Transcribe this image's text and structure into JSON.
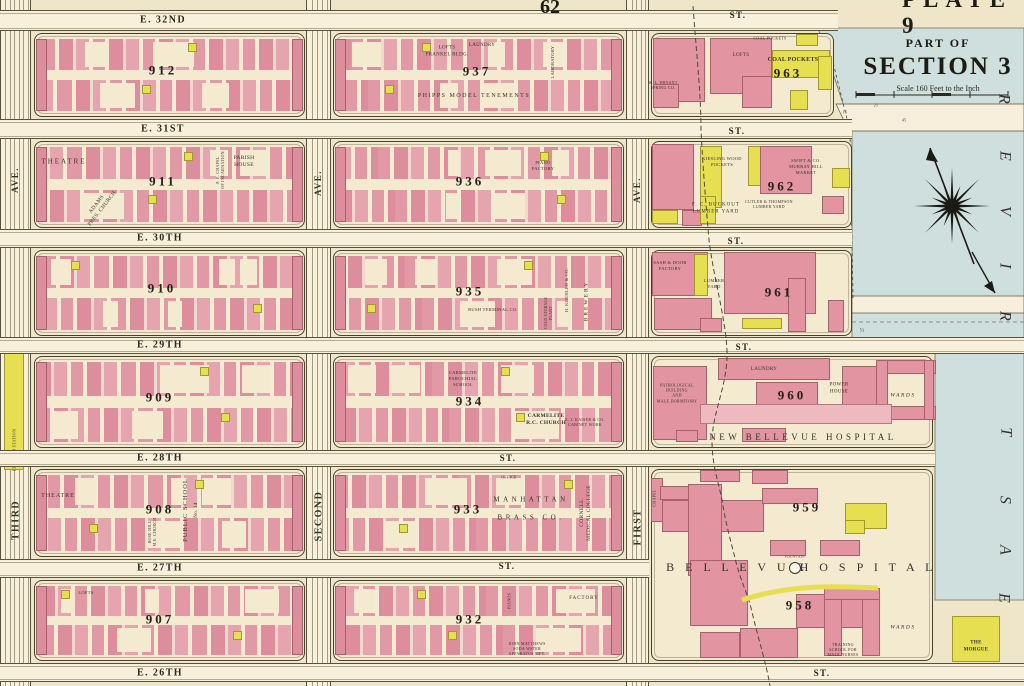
{
  "titles": {
    "plate_corner": "PLATE 9",
    "page_number": "62"
  },
  "section_panel": {
    "part_of": "PART OF",
    "title": "SECTION 3",
    "scale": "Scale 160 Feet to the Inch"
  },
  "water": {
    "name": "EAST RIVER"
  },
  "avenues": [
    {
      "name": "THIRD",
      "suffix": "AVE.",
      "x1": 0,
      "x2": 31,
      "sy": 180,
      "ny": 520,
      "station": "ELEVATED STATION",
      "stay": 450
    },
    {
      "name": "SECOND",
      "suffix": "AVE.",
      "x1": 306,
      "x2": 331,
      "sy": 183,
      "ny": 516
    },
    {
      "name": "FIRST",
      "suffix": "AVE.",
      "x1": 626,
      "x2": 649,
      "sy": 190,
      "ny": 527
    }
  ],
  "streets": [
    {
      "name": "E. 32ND",
      "suffix": "ST.",
      "y1": 10,
      "y2": 31,
      "x1": 0,
      "x2": 838,
      "nx": 163,
      "ny": 20,
      "st": [
        [
          738,
          15
        ]
      ]
    },
    {
      "name": "E. 31ST",
      "suffix": "ST.",
      "y1": 119,
      "y2": 139,
      "x1": 0,
      "x2": 852,
      "nx": 163,
      "ny": 129,
      "st": [
        [
          737,
          131
        ]
      ]
    },
    {
      "name": "E. 30TH",
      "suffix": "ST.",
      "y1": 229,
      "y2": 248,
      "x1": 0,
      "x2": 852,
      "nx": 160,
      "ny": 238,
      "st": [
        [
          736,
          241
        ]
      ]
    },
    {
      "name": "E. 29TH",
      "suffix": "ST.",
      "y1": 337,
      "y2": 354,
      "x1": 0,
      "x2": 1024,
      "nx": 160,
      "ny": 345,
      "st": [
        [
          744,
          347
        ]
      ]
    },
    {
      "name": "E. 28TH",
      "suffix": "ST.",
      "y1": 450,
      "y2": 467,
      "x1": 0,
      "x2": 935,
      "nx": 160,
      "ny": 458,
      "st": [
        [
          508,
          458
        ]
      ]
    },
    {
      "name": "E. 27TH",
      "suffix": "ST.",
      "y1": 559,
      "y2": 578,
      "x1": 0,
      "x2": 649,
      "nx": 160,
      "ny": 568,
      "st": [
        [
          507,
          566
        ]
      ]
    },
    {
      "name": "E. 26TH",
      "suffix": "ST.",
      "y1": 663,
      "y2": 682,
      "x1": 0,
      "x2": 1024,
      "nx": 160,
      "ny": 673,
      "st": [
        [
          822,
          673
        ]
      ]
    }
  ],
  "blocks": [
    {
      "number": "912",
      "bounds": [
        34,
        33,
        305,
        117
      ],
      "nx": 163,
      "ny": 71,
      "std": true
    },
    {
      "number": "937",
      "bounds": [
        333,
        33,
        624,
        117
      ],
      "nx": 477,
      "ny": 72,
      "std": true
    },
    {
      "number": "963",
      "bounds": [
        651,
        33,
        834,
        117
      ],
      "nx": 788,
      "ny": 74,
      "std": false,
      "dec": "b963"
    },
    {
      "number": "911",
      "bounds": [
        34,
        141,
        305,
        228
      ],
      "nx": 163,
      "ny": 182,
      "std": true
    },
    {
      "number": "936",
      "bounds": [
        333,
        141,
        624,
        228
      ],
      "nx": 470,
      "ny": 182,
      "std": true
    },
    {
      "number": "962",
      "bounds": [
        651,
        141,
        852,
        228
      ],
      "nx": 782,
      "ny": 187,
      "std": false,
      "dec": "b962"
    },
    {
      "number": "910",
      "bounds": [
        34,
        250,
        305,
        336
      ],
      "nx": 162,
      "ny": 289,
      "std": true
    },
    {
      "number": "935",
      "bounds": [
        333,
        250,
        624,
        336
      ],
      "nx": 470,
      "ny": 292,
      "std": true
    },
    {
      "number": "961",
      "bounds": [
        651,
        250,
        852,
        336
      ],
      "nx": 779,
      "ny": 293,
      "std": false,
      "dec": "b961"
    },
    {
      "number": "909",
      "bounds": [
        34,
        356,
        305,
        448
      ],
      "nx": 160,
      "ny": 398,
      "std": true
    },
    {
      "number": "934",
      "bounds": [
        333,
        356,
        624,
        448
      ],
      "nx": 470,
      "ny": 402,
      "std": true
    },
    {
      "number": "960",
      "bounds": [
        651,
        356,
        933,
        448
      ],
      "nx": 792,
      "ny": 396,
      "std": false,
      "dec": "b960"
    },
    {
      "number": "908",
      "bounds": [
        34,
        469,
        305,
        557
      ],
      "nx": 160,
      "ny": 510,
      "std": true
    },
    {
      "number": "933",
      "bounds": [
        333,
        469,
        624,
        557
      ],
      "nx": 468,
      "ny": 510,
      "std": true
    },
    {
      "number": "959",
      "bounds": [
        651,
        469,
        933,
        661
      ],
      "nx": 807,
      "ny": 508,
      "std": false,
      "dec": "campus"
    },
    {
      "number": "907",
      "bounds": [
        34,
        580,
        305,
        661
      ],
      "nx": 160,
      "ny": 620,
      "std": true
    },
    {
      "number": "932",
      "bounds": [
        333,
        580,
        624,
        661
      ],
      "nx": 470,
      "ny": 620,
      "std": true
    },
    {
      "number": "958",
      "bounds": null,
      "nx": 800,
      "ny": 606
    }
  ],
  "labels": [
    {
      "t": "LOFTS\nFRANKEL BLDG.",
      "x": 447,
      "y": 52,
      "s": 5
    },
    {
      "t": "LAUNDRY",
      "x": 482,
      "y": 46,
      "s": 5
    },
    {
      "t": "LABORATORY",
      "x": 553,
      "y": 62,
      "s": 4.5,
      "r": -90
    },
    {
      "t": "PHIPPS MODEL TENEMENTS",
      "x": 474,
      "y": 97,
      "s": 6,
      "sp": 1.5
    },
    {
      "t": "COAL POCKETS",
      "x": 770,
      "y": 38,
      "s": 4
    },
    {
      "t": "LOFTS",
      "x": 741,
      "y": 56,
      "s": 5
    },
    {
      "t": "COAL POCKETS",
      "x": 793,
      "y": 61,
      "s": 6,
      "b": 1
    },
    {
      "t": "W. L. BRYANT\nSPRING CO.",
      "x": 663,
      "y": 85,
      "s": 4
    },
    {
      "t": "THEATRE",
      "x": 64,
      "y": 162,
      "s": 7,
      "sp": 2
    },
    {
      "t": "ADAMS\nPRES. CHURCH",
      "x": 100,
      "y": 207,
      "s": 5.5,
      "r": -52
    },
    {
      "t": "P. E. CHAPEL\nOF INCARNATION",
      "x": 220,
      "y": 170,
      "s": 4,
      "r": -90
    },
    {
      "t": "PARISH\nHOUSE",
      "x": 244,
      "y": 162,
      "s": 5.5
    },
    {
      "t": "PIANO\nFACTORY",
      "x": 543,
      "y": 166,
      "s": 4.5
    },
    {
      "t": "KIESLING WOOD\nPOCKETS",
      "x": 722,
      "y": 162,
      "s": 4.5
    },
    {
      "t": "SWIFT & CO.\nMURRAY HILL\nMARKET",
      "x": 806,
      "y": 167,
      "s": 4.5
    },
    {
      "t": "F. C. BUCKOUT\nLUMBER YARD",
      "x": 716,
      "y": 209,
      "s": 5,
      "sp": 1
    },
    {
      "t": "CUTLER & THOMPSON\nLUMBER YARD",
      "x": 769,
      "y": 204,
      "s": 4
    },
    {
      "t": "BUSH TERMINAL CO.",
      "x": 493,
      "y": 310,
      "s": 4.5
    },
    {
      "t": "H. KOEHLER & CO.",
      "x": 567,
      "y": 290,
      "s": 4.5,
      "r": -90
    },
    {
      "t": "BREWERY",
      "x": 587,
      "y": 301,
      "s": 5.5,
      "r": -90,
      "sp": 2
    },
    {
      "t": "COLD STORAGE\nPLANT",
      "x": 549,
      "y": 313,
      "s": 3.8,
      "r": -90
    },
    {
      "t": "SASH & DOOR\nFACTORY",
      "x": 670,
      "y": 266,
      "s": 4.5
    },
    {
      "t": "LUMBER\nYARD",
      "x": 714,
      "y": 284,
      "s": 4.5
    },
    {
      "t": "CARMELITE\nPAROCHIAL\nSCHOOL",
      "x": 463,
      "y": 379,
      "s": 4.5
    },
    {
      "t": "CARMELITE\nR.C. CHURCH",
      "x": 546,
      "y": 420,
      "s": 5.5,
      "b": 1
    },
    {
      "t": "E. J. KAISER & CO.\nCABINET WORK",
      "x": 585,
      "y": 422,
      "s": 4
    },
    {
      "t": "PATHOLOGICAL\nBUILDING\nAND\nMALE DORMITORY",
      "x": 677,
      "y": 393,
      "s": 4
    },
    {
      "t": "LAUNDRY",
      "x": 764,
      "y": 370,
      "s": 5
    },
    {
      "t": "POWER\nHOUSE",
      "x": 839,
      "y": 389,
      "s": 5
    },
    {
      "t": "WARDS",
      "x": 903,
      "y": 396,
      "s": 5.5,
      "i": 1,
      "sp": 1.5
    },
    {
      "t": "NEW BELLEVUE HOSPITAL",
      "x": 803,
      "y": 438,
      "s": 9,
      "sp": 3.5
    },
    {
      "t": "THEATRE",
      "x": 58,
      "y": 497,
      "s": 6,
      "sp": 1
    },
    {
      "t": "PUBLIC SCHOOL",
      "x": 186,
      "y": 510,
      "s": 6.5,
      "r": -90,
      "sp": 1
    },
    {
      "t": "No. 14",
      "x": 197,
      "y": 510,
      "s": 5,
      "r": -90
    },
    {
      "t": "ROSE HILL\nM.E. CHURCH",
      "x": 152,
      "y": 532,
      "s": 4,
      "r": -90
    },
    {
      "t": "OFFICE",
      "x": 509,
      "y": 477,
      "s": 4
    },
    {
      "t": "MANHATTAN",
      "x": 531,
      "y": 500,
      "s": 7,
      "sp": 3.5
    },
    {
      "t": "BRASS CO.",
      "x": 531,
      "y": 518,
      "s": 7,
      "sp": 3.5
    },
    {
      "t": "CORNELL\nMEDICAL COLLEGE",
      "x": 586,
      "y": 513,
      "s": 5.5,
      "r": -90
    },
    {
      "t": "CHAPEL",
      "x": 654,
      "y": 498,
      "s": 4,
      "r": -90
    },
    {
      "t": "B E L L E V U E",
      "x": 737,
      "y": 568,
      "s": 12,
      "sp": 4
    },
    {
      "t": "H O S P I T A L",
      "x": 868,
      "y": 568,
      "s": 12,
      "sp": 4
    },
    {
      "t": "FOUNTAIN",
      "x": 795,
      "y": 557,
      "s": 3.5
    },
    {
      "t": "LOFTS",
      "x": 86,
      "y": 593,
      "s": 4.5
    },
    {
      "t": "FACTORY",
      "x": 584,
      "y": 599,
      "s": 5,
      "sp": 1
    },
    {
      "t": "PIANOS",
      "x": 509,
      "y": 601,
      "s": 4,
      "r": -90
    },
    {
      "t": "JOHN MATTHEWS\nSODA WATER\nAPPARATUS MFY.",
      "x": 527,
      "y": 649,
      "s": 4
    },
    {
      "t": "WARDS",
      "x": 903,
      "y": 628,
      "s": 5.5,
      "i": 1,
      "sp": 1.5
    },
    {
      "t": "TRAINING\nSCHOOL FOR\nMALE NURSES",
      "x": 843,
      "y": 650,
      "s": 4
    },
    {
      "t": "THE\nMORGUE",
      "x": 976,
      "y": 647,
      "s": 5,
      "b": 1
    },
    {
      "t": "15",
      "x": 845,
      "y": 112,
      "s": 4
    },
    {
      "t": "45",
      "x": 904,
      "y": 120,
      "s": 4
    },
    {
      "t": "21",
      "x": 876,
      "y": 105,
      "s": 4
    },
    {
      "t": "53",
      "x": 862,
      "y": 330,
      "s": 4
    },
    {
      "t": "R",
      "x": 1003,
      "y": 99,
      "s": 16,
      "i": 1,
      "r": 90
    },
    {
      "t": "E",
      "x": 1004,
      "y": 156,
      "s": 16,
      "i": 1,
      "r": 90
    },
    {
      "t": "V",
      "x": 1004,
      "y": 211,
      "s": 16,
      "i": 1,
      "r": 90
    },
    {
      "t": "I",
      "x": 1004,
      "y": 266,
      "s": 16,
      "i": 1,
      "r": 90
    },
    {
      "t": "R",
      "x": 1004,
      "y": 316,
      "s": 16,
      "i": 1,
      "r": 90
    },
    {
      "t": "T",
      "x": 1005,
      "y": 432,
      "s": 16,
      "i": 1,
      "r": 90
    },
    {
      "t": "S",
      "x": 1004,
      "y": 500,
      "s": 16,
      "i": 1,
      "r": 90
    },
    {
      "t": "A",
      "x": 1004,
      "y": 550,
      "s": 16,
      "i": 1,
      "r": 90
    },
    {
      "t": "E",
      "x": 1003,
      "y": 598,
      "s": 16,
      "i": 1,
      "r": 90
    }
  ]
}
